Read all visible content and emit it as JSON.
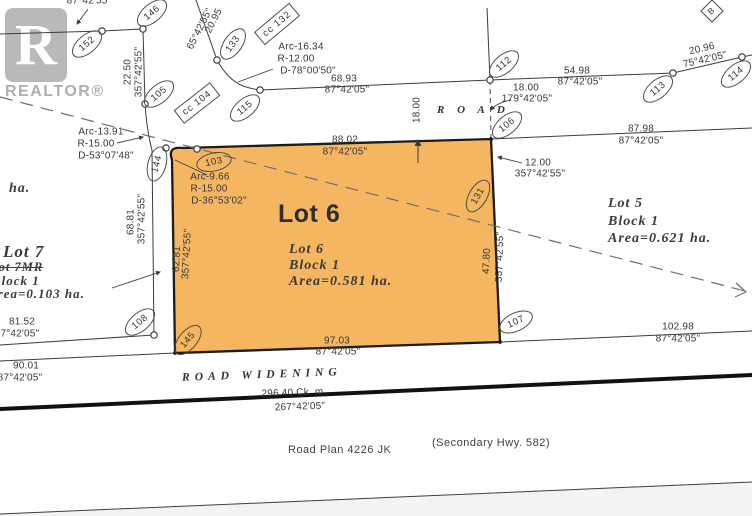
{
  "watermark": {
    "letter": "R",
    "brand": "REALTOR®"
  },
  "highlight": {
    "fill": "#F5B661",
    "stroke": "#1c1c1c"
  },
  "lot6": {
    "title": "Lot 6",
    "name": "Lot 6",
    "block": "Block 1",
    "area": "Area=0.581 ha."
  },
  "lot5": {
    "name": "Lot 5",
    "block": "Block 1",
    "area": "Area=0.621 ha."
  },
  "lot7": {
    "name": "Lot 7",
    "name_struck": "Lot 7MR",
    "block": "Block 1",
    "area": "Area=0.103 ha.",
    "fragment": "ha."
  },
  "roads": {
    "road": "R O A D",
    "widening": "ROAD WIDENING",
    "plan": "Road Plan 4226 JK",
    "hwy": "(Secondary Hwy. 582)"
  },
  "corner_marker": "B",
  "dim_labels": [
    {
      "t": "87°42'55\"",
      "x": 89,
      "y": 1
    },
    {
      "t": "20.95",
      "x": 214,
      "y": 21,
      "r": -63
    },
    {
      "t": "65°42'55\"",
      "x": 200,
      "y": 29,
      "r": -63
    },
    {
      "t": "Arc-16.34",
      "x": 301,
      "y": 47
    },
    {
      "t": "R-12.00",
      "x": 296,
      "y": 59
    },
    {
      "t": "D-78°00'50\"",
      "x": 308,
      "y": 71
    },
    {
      "t": "68.93",
      "x": 344,
      "y": 79
    },
    {
      "t": "87°42'05\"",
      "x": 347,
      "y": 90
    },
    {
      "t": "54.98",
      "x": 577,
      "y": 71
    },
    {
      "t": "87°42'05\"",
      "x": 580,
      "y": 82
    },
    {
      "t": "20.96",
      "x": 702,
      "y": 49,
      "r": -13
    },
    {
      "t": "75°42'05\"",
      "x": 705,
      "y": 60,
      "r": -13
    },
    {
      "t": "18.00",
      "x": 526,
      "y": 88
    },
    {
      "t": "179°42'05\"",
      "x": 527,
      "y": 99
    },
    {
      "t": "18.00",
      "x": 417,
      "y": 110,
      "r": -90
    },
    {
      "t": "22.50",
      "x": 128,
      "y": 72,
      "r": -90
    },
    {
      "t": "357°42'55\"",
      "x": 139,
      "y": 72,
      "r": -90
    },
    {
      "t": "88.02",
      "x": 345,
      "y": 140
    },
    {
      "t": "87°42'05\"",
      "x": 345,
      "y": 152
    },
    {
      "t": "87.98",
      "x": 641,
      "y": 129
    },
    {
      "t": "87°42'05\"",
      "x": 641,
      "y": 141
    },
    {
      "t": "12.00",
      "x": 538,
      "y": 163
    },
    {
      "t": "357°42'55\"",
      "x": 540,
      "y": 174
    },
    {
      "t": "Arc-13.91",
      "x": 101,
      "y": 132
    },
    {
      "t": "R-15.00",
      "x": 96,
      "y": 144
    },
    {
      "t": "D-53°07'48\"",
      "x": 106,
      "y": 156
    },
    {
      "t": "Arc-9.66",
      "x": 210,
      "y": 177
    },
    {
      "t": "R-15.00",
      "x": 209,
      "y": 189
    },
    {
      "t": "D-36°53'02\"",
      "x": 219,
      "y": 201
    },
    {
      "t": "68.81",
      "x": 131,
      "y": 222,
      "r": -90
    },
    {
      "t": "357°42'55\"",
      "x": 142,
      "y": 219,
      "r": -90
    },
    {
      "t": "62.81",
      "x": 177,
      "y": 259,
      "r": -87
    },
    {
      "t": "357°42'55\"",
      "x": 187,
      "y": 254,
      "r": -87
    },
    {
      "t": "47.80",
      "x": 487,
      "y": 261,
      "r": -88
    },
    {
      "t": "357°42'55\"",
      "x": 500,
      "y": 257,
      "r": -88
    },
    {
      "t": "81.52",
      "x": 22,
      "y": 322
    },
    {
      "t": "87°42'05\"",
      "x": 17,
      "y": 334
    },
    {
      "t": "90.01",
      "x": 26,
      "y": 366
    },
    {
      "t": "87°42'05\"",
      "x": 20,
      "y": 378
    },
    {
      "t": "97.03",
      "x": 337,
      "y": 341
    },
    {
      "t": "87°42'05\"",
      "x": 338,
      "y": 352
    },
    {
      "t": "102.98",
      "x": 678,
      "y": 327
    },
    {
      "t": "87°42'05\"",
      "x": 678,
      "y": 339
    },
    {
      "t": "296.40  Ck. m.",
      "x": 294,
      "y": 393,
      "r": -2
    },
    {
      "t": "267°42'05\"",
      "x": 300,
      "y": 407,
      "r": -2
    }
  ],
  "bubbles": [
    {
      "t": "152",
      "x": 87,
      "y": 44,
      "r": -40
    },
    {
      "t": "146",
      "x": 152,
      "y": 13,
      "r": -40
    },
    {
      "t": "133",
      "x": 233,
      "y": 44,
      "r": -55
    },
    {
      "t": "105",
      "x": 159,
      "y": 94,
      "r": -40
    },
    {
      "t": "115",
      "x": 245,
      "y": 108,
      "r": -40
    },
    {
      "t": "112",
      "x": 504,
      "y": 64,
      "r": -40
    },
    {
      "t": "113",
      "x": 658,
      "y": 89,
      "r": -40
    },
    {
      "t": "114",
      "x": 736,
      "y": 74,
      "r": -40
    },
    {
      "t": "106",
      "x": 507,
      "y": 125,
      "r": -40
    },
    {
      "t": "103",
      "x": 214,
      "y": 162,
      "r": -12
    },
    {
      "t": "144",
      "x": 157,
      "y": 164,
      "r": -75
    },
    {
      "t": "131",
      "x": 478,
      "y": 196,
      "r": -60
    },
    {
      "t": "108",
      "x": 140,
      "y": 322,
      "r": -40
    },
    {
      "t": "145",
      "x": 188,
      "y": 340,
      "r": -50
    },
    {
      "t": "107",
      "x": 516,
      "y": 322,
      "r": -25
    }
  ],
  "box_tags": [
    {
      "t": "cc 132",
      "x": 277,
      "y": 24,
      "r": -40
    },
    {
      "t": "cc 104",
      "x": 197,
      "y": 103,
      "r": -38
    }
  ],
  "monuments": [
    [
      102,
      31
    ],
    [
      143,
      29
    ],
    [
      145,
      104
    ],
    [
      154,
      335
    ],
    [
      260,
      90
    ],
    [
      217,
      60
    ],
    [
      490,
      80
    ],
    [
      673,
      73
    ],
    [
      742,
      57
    ],
    [
      166,
      148
    ],
    [
      197,
      149
    ]
  ],
  "corner_dots": [
    [
      491,
      139
    ],
    [
      500,
      342
    ],
    [
      175,
      353
    ]
  ]
}
